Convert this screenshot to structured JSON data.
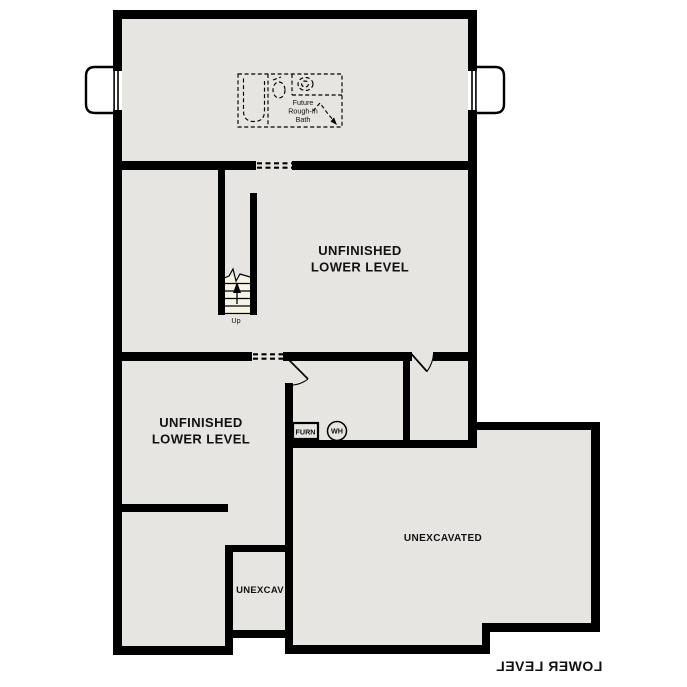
{
  "title": {
    "label": "LOWER LEVEL"
  },
  "colors": {
    "floor": "#e6e5e2",
    "wall": "#000000",
    "stair": "#f7f3e5",
    "bg": "#ffffff"
  },
  "rooms": {
    "middle": {
      "line1": "UNFINISHED",
      "line2": "LOWER LEVEL"
    },
    "lower_left": {
      "line1": "UNFINISHED",
      "line2": "LOWER LEVEL"
    },
    "unexcavated": {
      "label": "UNEXCAVATED"
    },
    "unexcav": {
      "label": "UNEXCAV"
    }
  },
  "bath": {
    "line1": "Future",
    "line2": "Rough-In",
    "line3": "Bath"
  },
  "fixtures": {
    "furnace": "FURN",
    "water_heater": "WH"
  },
  "stairs": {
    "direction_label": "Up"
  }
}
